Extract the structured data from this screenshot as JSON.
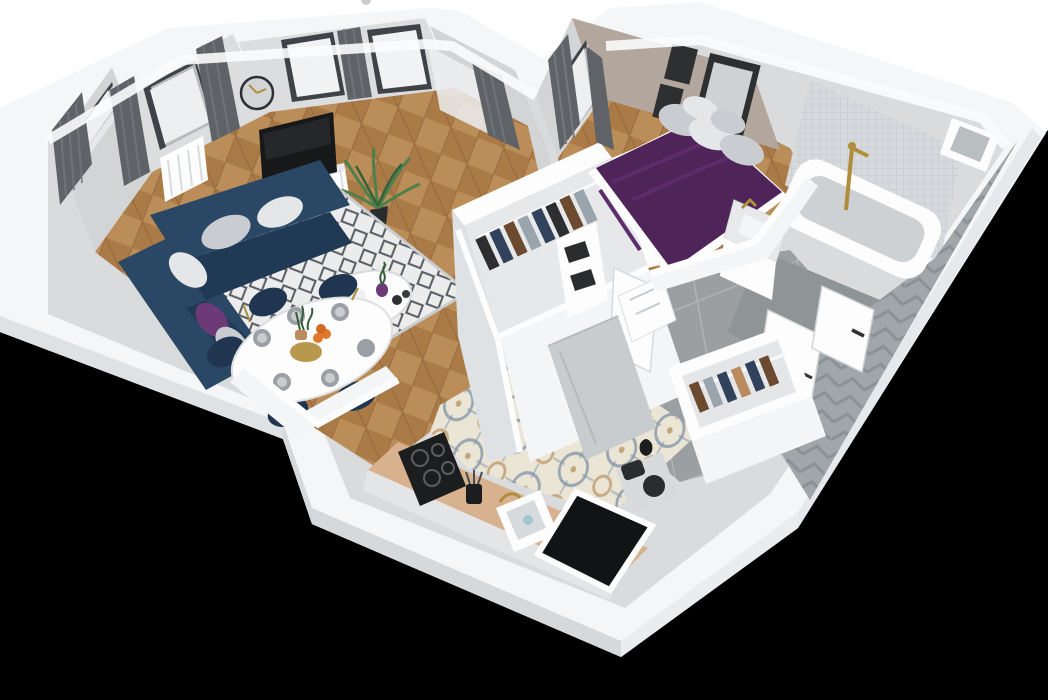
{
  "meta": {
    "kind": "3d-floorplan-render",
    "view": "axonometric dollhouse, no visible UI text"
  },
  "palette": {
    "bgWhite": "#ffffff",
    "bgVoid": "#000000",
    "wallCap": "#f5f6f8",
    "wallCapLit": "#fbfcfd",
    "faceSW": "#dfe2e5",
    "faceS": "#d6d9dc",
    "faceSE": "#eaecee",
    "faceE": "#e6e9eb",
    "innerBase": "#d9dbdd",
    "wallInner": "#d3d4d6",
    "wallInner2": "#dcdddf",
    "wallTaupe": "#b2a69d",
    "wood1": "#ab7b47",
    "wood2": "#bb8d58",
    "woodLine": "#8a6138",
    "tileBase": "#ebe5d6",
    "tileBlue": "#7e93a6",
    "tileTan": "#c2a57c",
    "grayTile": "#9b9fa2",
    "grayGrout": "#b4b8ba",
    "rugBase": "#ececec",
    "rugLine": "#585d63",
    "sofaNavy": "#2a4866",
    "sofaDark": "#203a55",
    "chairNavy": "#1f3550",
    "pillowGray": "#c9ccd0",
    "pillowLight": "#e4e6e8",
    "pillowPurple": "#6b3a77",
    "curtainDark": "#5f6367",
    "curtainMid": "#75797d",
    "sheer": "#eceef0",
    "windowPane": "#f0f2f3",
    "windowFrame": "#3f4347",
    "tvBlack": "#17181a",
    "gold": "#b08d3a",
    "plantGreen": "#4f7f4a",
    "plantDark": "#36603a",
    "duvetPurple": "#4e2459",
    "duvetFold": "#5d2c6a",
    "frameDark": "#2d2f31",
    "mosaic": "#d6dadd",
    "mosaicLine": "#c3c7ca",
    "chevBase": "#a0a6a9",
    "chevLine": "#8b9194",
    "white": "#f4f5f6",
    "whiteBright": "#fdfdfe",
    "counterWood": "#d8b28e",
    "counterWood2": "#c9a07b",
    "applianceBlack": "#1c1d1f",
    "applianceGray": "#c9ccce",
    "boxBlack": "#2b2c2e",
    "marble": "#e8e9ea",
    "tubInner": "#cdd1d3",
    "floorGray": "#8f9496",
    "clothA": "#6b4a2f",
    "clothB": "#31425c",
    "clothC": "#9aa4ad",
    "clothD": "#2e2e30",
    "clothE": "#b98b5e",
    "orange": "#e07a2a",
    "plate": "#9aa0a5"
  },
  "scene": {
    "rooms": [
      {
        "name": "living-room",
        "floor": "herringbone-wood",
        "objects": [
          "corner-sofa",
          "area-rug",
          "coffee-table",
          "tv",
          "tv-sideboard",
          "potted-palm",
          "wall-clock",
          "radiator",
          "curtained-windows",
          "dining-table",
          "dining-chairs"
        ]
      },
      {
        "name": "kitchen",
        "floor": "patterned-cement-tile",
        "objects": [
          "wood-countertop",
          "induction-cooktop",
          "sink",
          "gold-faucet",
          "kettle",
          "coffee-machine",
          "utensil-cup",
          "tall-gray-cabinet",
          "window-opening"
        ]
      },
      {
        "name": "bedroom",
        "floor": "herringbone-wood",
        "objects": [
          "double-bed-purple-duvet",
          "gray-pillows",
          "wall-art-frames",
          "curtains",
          "storage-shelf-black-boxes",
          "walk-in-wardrobe",
          "drawer-unit"
        ]
      },
      {
        "name": "bathroom",
        "floor": "gray-tile",
        "objects": [
          "bathtub",
          "gold-shower-set",
          "vanity-sink",
          "toilet",
          "mosaic-tile-wall",
          "chevron-tile-wall",
          "wall-niche",
          "open-door"
        ]
      },
      {
        "name": "hallway",
        "floor": "large-gray-tile",
        "objects": [
          "open-wardrobe-hangers",
          "entry-door"
        ]
      }
    ]
  }
}
